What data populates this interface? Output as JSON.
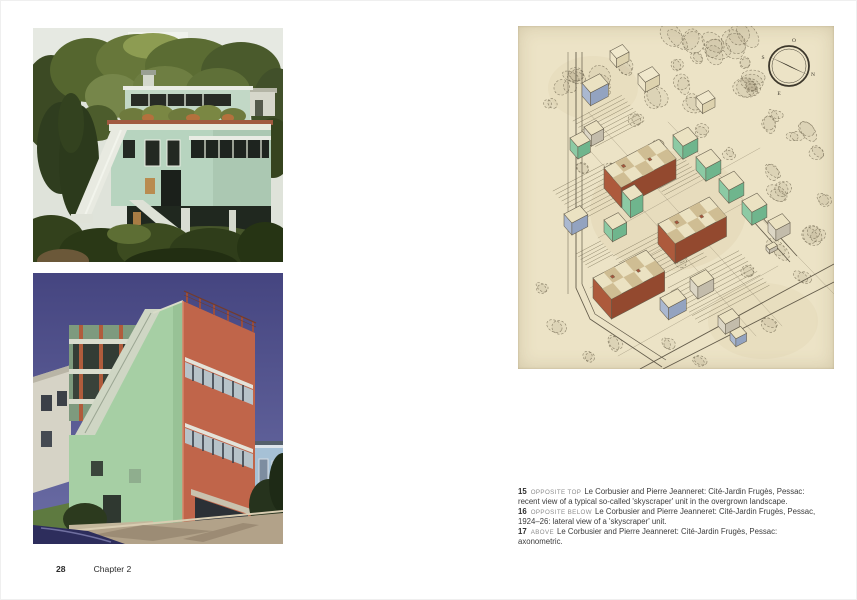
{
  "page": {
    "background": "#ffffff",
    "footer": {
      "page_number": "28",
      "chapter": "Chapter 2"
    }
  },
  "left_page": {
    "photos": [
      {
        "id": "photo-top",
        "depicts": "Recent view of a typical so-called 'skyscraper' unit in the overgrown landscape, Cité-Jardin Frugès, Pessac"
      },
      {
        "id": "photo-bottom",
        "depicts": "Lateral view of a 'skyscraper' unit, Cité-Jardin Frugès, Pessac, 1924–26"
      }
    ]
  },
  "right_page": {
    "drawing": {
      "title": "Cité-Jardin Frugès, Pessac: axonometric",
      "paper_color": "#ece3c6",
      "ink_color": "#645c4b",
      "building_colors": {
        "terracotta": {
          "sw": "#ad5a3c",
          "se": "#93492f"
        },
        "green": {
          "sw": "#8ccaa4",
          "se": "#6fb58d"
        },
        "blue": {
          "sw": "#aab8d0",
          "se": "#93a3c0"
        },
        "grey": {
          "sw": "#dcd6c5",
          "se": "#c3bcab"
        },
        "sketch": {
          "sw": "#eee5c8",
          "se": "#ddd2ae",
          "roof": "#f0e8cc"
        },
        "roof": "#ebe2c2",
        "roof_check": "#cfbd93",
        "chimney": "#a5573c"
      },
      "compass": {
        "cx": 271,
        "cy": 40,
        "r": 20,
        "labels": {
          "top": "O",
          "left": "S",
          "right": "N",
          "bottom": "E"
        }
      },
      "buildings": [
        {
          "x": 86,
          "y": 162,
          "a": 62,
          "b": 26,
          "h": 20,
          "color": "terracotta",
          "checker": true
        },
        {
          "x": 140,
          "y": 218,
          "a": 58,
          "b": 26,
          "h": 20,
          "color": "terracotta",
          "checker": true
        },
        {
          "x": 75,
          "y": 272,
          "a": 60,
          "b": 28,
          "h": 20,
          "color": "terracotta",
          "checker": true
        },
        {
          "x": 155,
          "y": 122,
          "a": 17,
          "b": 15,
          "h": 13,
          "color": "green"
        },
        {
          "x": 178,
          "y": 144,
          "a": 17,
          "b": 15,
          "h": 13,
          "color": "green"
        },
        {
          "x": 201,
          "y": 166,
          "a": 17,
          "b": 15,
          "h": 13,
          "color": "green"
        },
        {
          "x": 224,
          "y": 188,
          "a": 17,
          "b": 15,
          "h": 13,
          "color": "green"
        },
        {
          "x": 250,
          "y": 206,
          "a": 16,
          "b": 12,
          "h": 11,
          "color": "grey"
        },
        {
          "x": 104,
          "y": 182,
          "a": 14,
          "b": 13,
          "h": 17,
          "color": "green"
        },
        {
          "x": 86,
          "y": 206,
          "a": 16,
          "b": 13,
          "h": 12,
          "color": "green"
        },
        {
          "x": 52,
          "y": 124,
          "a": 14,
          "b": 12,
          "h": 12,
          "color": "green"
        },
        {
          "x": 66,
          "y": 112,
          "a": 14,
          "b": 11,
          "h": 11,
          "color": "grey"
        },
        {
          "x": 64,
          "y": 70,
          "a": 20,
          "b": 13,
          "h": 13,
          "color": "blue"
        },
        {
          "x": 46,
          "y": 200,
          "a": 18,
          "b": 12,
          "h": 12,
          "color": "blue"
        },
        {
          "x": 142,
          "y": 284,
          "a": 20,
          "b": 13,
          "h": 12,
          "color": "blue"
        },
        {
          "x": 172,
          "y": 264,
          "a": 18,
          "b": 12,
          "h": 12,
          "color": "grey"
        },
        {
          "x": 200,
          "y": 300,
          "a": 16,
          "b": 11,
          "h": 10,
          "color": "grey"
        },
        {
          "x": 212,
          "y": 314,
          "a": 12,
          "b": 9,
          "h": 8,
          "color": "blue"
        },
        {
          "x": 120,
          "y": 58,
          "a": 16,
          "b": 11,
          "h": 10,
          "color": "sketch"
        },
        {
          "x": 178,
          "y": 80,
          "a": 14,
          "b": 10,
          "h": 9,
          "color": "sketch"
        },
        {
          "x": 92,
          "y": 34,
          "a": 14,
          "b": 10,
          "h": 9,
          "color": "sketch"
        },
        {
          "x": 248,
          "y": 224,
          "a": 9,
          "b": 5,
          "h": 4,
          "color": "grey"
        }
      ],
      "hatches": [
        {
          "x": 55,
          "y": 95,
          "a": 55,
          "b": 34,
          "n": 8
        },
        {
          "x": 35,
          "y": 165,
          "a": 58,
          "b": 40,
          "n": 9
        },
        {
          "x": 95,
          "y": 230,
          "a": 72,
          "b": 45,
          "n": 10
        },
        {
          "x": 150,
          "y": 262,
          "a": 80,
          "b": 46,
          "n": 10
        },
        {
          "x": 130,
          "y": 150,
          "a": 40,
          "b": 25,
          "n": 6
        },
        {
          "x": 58,
          "y": 228,
          "a": 28,
          "b": 18,
          "n": 5
        }
      ],
      "roads": [
        {
          "pts": [
            [
              58,
              26
            ],
            [
              58,
              262
            ],
            [
              72,
              293
            ],
            [
              144,
              341
            ]
          ],
          "w": 0.9
        },
        {
          "pts": [
            [
              64,
              26
            ],
            [
              64,
              258
            ],
            [
              77,
              288
            ],
            [
              148,
              334
            ]
          ],
          "w": 0.7
        },
        {
          "pts": [
            [
              50,
              26
            ],
            [
              50,
              268
            ]
          ],
          "w": 0.5
        },
        {
          "pts": [
            [
              122,
              343
            ],
            [
              316,
              238
            ]
          ],
          "w": 0.9
        },
        {
          "pts": [
            [
              145,
              343
            ],
            [
              316,
              256
            ]
          ],
          "w": 0.9
        },
        {
          "pts": [
            [
              236,
              196
            ],
            [
              272,
              236
            ]
          ],
          "w": 0.8
        },
        {
          "pts": [
            [
              243,
              190
            ],
            [
              279,
              230
            ]
          ],
          "w": 0.8
        }
      ],
      "guides": [
        [
          [
            66,
            118
          ],
          [
            238,
            310
          ]
        ],
        [
          [
            70,
            86
          ],
          [
            264,
            300
          ]
        ],
        [
          [
            150,
            96
          ],
          [
            316,
            268
          ]
        ],
        [
          [
            80,
            212
          ],
          [
            242,
            122
          ]
        ],
        [
          [
            72,
            262
          ],
          [
            238,
            170
          ]
        ],
        [
          [
            100,
            330
          ],
          [
            260,
            240
          ]
        ]
      ],
      "tree_spots": [
        [
          95,
          142,
          7
        ],
        [
          62,
          140,
          6
        ],
        [
          185,
          104,
          7
        ],
        [
          210,
          128,
          6
        ],
        [
          160,
          232,
          7
        ],
        [
          118,
          254,
          6
        ],
        [
          232,
          244,
          7
        ],
        [
          284,
          252,
          8
        ],
        [
          40,
          300,
          8
        ],
        [
          95,
          316,
          7
        ],
        [
          150,
          318,
          6
        ],
        [
          265,
          162,
          7
        ],
        [
          298,
          208,
          8
        ],
        [
          26,
          262,
          6
        ],
        [
          250,
          298,
          7
        ],
        [
          70,
          330,
          6
        ],
        [
          180,
          334,
          6
        ],
        [
          118,
          92,
          6
        ],
        [
          142,
          118,
          5
        ]
      ]
    },
    "captions": [
      {
        "number": "15",
        "position": "OPPOSITE TOP",
        "text": "Le Corbusier and Pierre Jeanneret: Cité-Jardin Frugès, Pessac: recent view of a typical so-called 'skyscraper' unit in the overgrown landscape."
      },
      {
        "number": "16",
        "position": "OPPOSITE BELOW",
        "text": "Le Corbusier and Pierre Jeanneret: Cité-Jardin Frugès, Pessac, 1924–26: lateral view of a 'skyscraper' unit."
      },
      {
        "number": "17",
        "position": "ABOVE",
        "text": "Le Corbusier and Pierre Jeanneret: Cité-Jardin Frugès, Pessac: axonometric."
      }
    ]
  }
}
